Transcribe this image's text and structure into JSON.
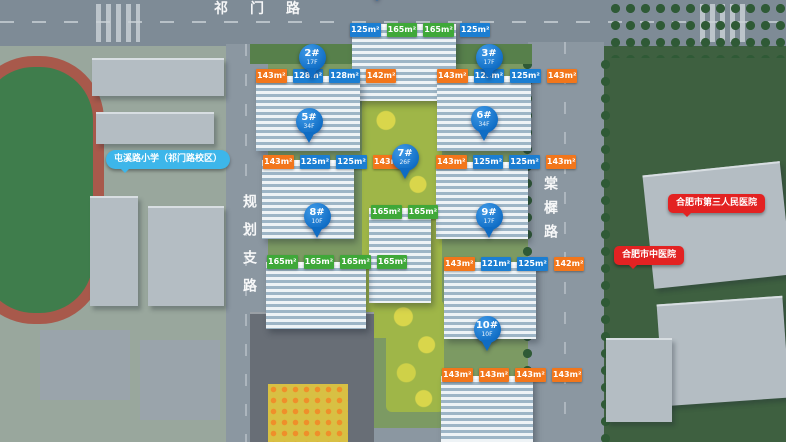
{
  "roads": {
    "top": "祁门路",
    "left": "规划支路",
    "right": "棠樨路"
  },
  "poi": {
    "school": "屯溪路小学（祁门路校区）",
    "hospital_top": "合肥市第三人民医院",
    "hospital_bottom": "合肥市中医院"
  },
  "colors": {
    "pin_blue": "#0f6cc4",
    "unit_blue": "#1b7ed2",
    "unit_orange": "#f2761b",
    "unit_green": "#3fa839",
    "bubble_blue": "#3db6ea",
    "bubble_red": "#e32222"
  },
  "pins": [
    {
      "number": "2#",
      "sub": "17F"
    },
    {
      "number": "3#",
      "sub": "17F"
    },
    {
      "number": "5#",
      "sub": "34F"
    },
    {
      "number": "6#",
      "sub": "34F"
    },
    {
      "number": "7#",
      "sub": "26F"
    },
    {
      "number": "8#",
      "sub": "10F"
    },
    {
      "number": "9#",
      "sub": "17F"
    },
    {
      "number": "10#",
      "sub": "10F"
    }
  ],
  "buildings": [
    {
      "name": "top-building",
      "units": [
        {
          "label": "125m²",
          "type": "blue"
        },
        {
          "label": "165m²",
          "type": "green"
        },
        {
          "label": "165m²",
          "type": "green"
        },
        {
          "label": "125m²",
          "type": "blue"
        }
      ]
    },
    {
      "name": "building-2",
      "units": [
        {
          "label": "143m²",
          "type": "orange"
        },
        {
          "label": "128m²",
          "type": "blue"
        },
        {
          "label": "128m²",
          "type": "blue"
        },
        {
          "label": "142m²",
          "type": "orange"
        }
      ]
    },
    {
      "name": "building-3",
      "units": [
        {
          "label": "143m²",
          "type": "orange"
        },
        {
          "label": "125m²",
          "type": "blue"
        },
        {
          "label": "125m²",
          "type": "blue"
        },
        {
          "label": "143m²",
          "type": "orange"
        }
      ]
    },
    {
      "name": "building-5",
      "units": [
        {
          "label": "143m²",
          "type": "orange"
        },
        {
          "label": "125m²",
          "type": "blue"
        },
        {
          "label": "125m²",
          "type": "blue"
        },
        {
          "label": "143m²",
          "type": "orange"
        }
      ]
    },
    {
      "name": "building-6",
      "units": [
        {
          "label": "143m²",
          "type": "orange"
        },
        {
          "label": "125m²",
          "type": "blue"
        },
        {
          "label": "125m²",
          "type": "blue"
        },
        {
          "label": "143m²",
          "type": "orange"
        }
      ]
    },
    {
      "name": "building-7",
      "units": [
        {
          "label": "165m²",
          "type": "green"
        },
        {
          "label": "165m²",
          "type": "green"
        }
      ]
    },
    {
      "name": "building-8",
      "units": [
        {
          "label": "165m²",
          "type": "green"
        },
        {
          "label": "165m²",
          "type": "green"
        },
        {
          "label": "165m²",
          "type": "green"
        },
        {
          "label": "165m²",
          "type": "green"
        }
      ]
    },
    {
      "name": "building-9",
      "units": [
        {
          "label": "143m²",
          "type": "orange"
        },
        {
          "label": "121m²",
          "type": "blue"
        },
        {
          "label": "125m²",
          "type": "blue"
        },
        {
          "label": "142m²",
          "type": "orange"
        }
      ]
    },
    {
      "name": "building-10",
      "units": [
        {
          "label": "143m²",
          "type": "orange"
        },
        {
          "label": "143m²",
          "type": "orange"
        },
        {
          "label": "143m²",
          "type": "orange"
        },
        {
          "label": "143m²",
          "type": "orange"
        }
      ]
    }
  ]
}
